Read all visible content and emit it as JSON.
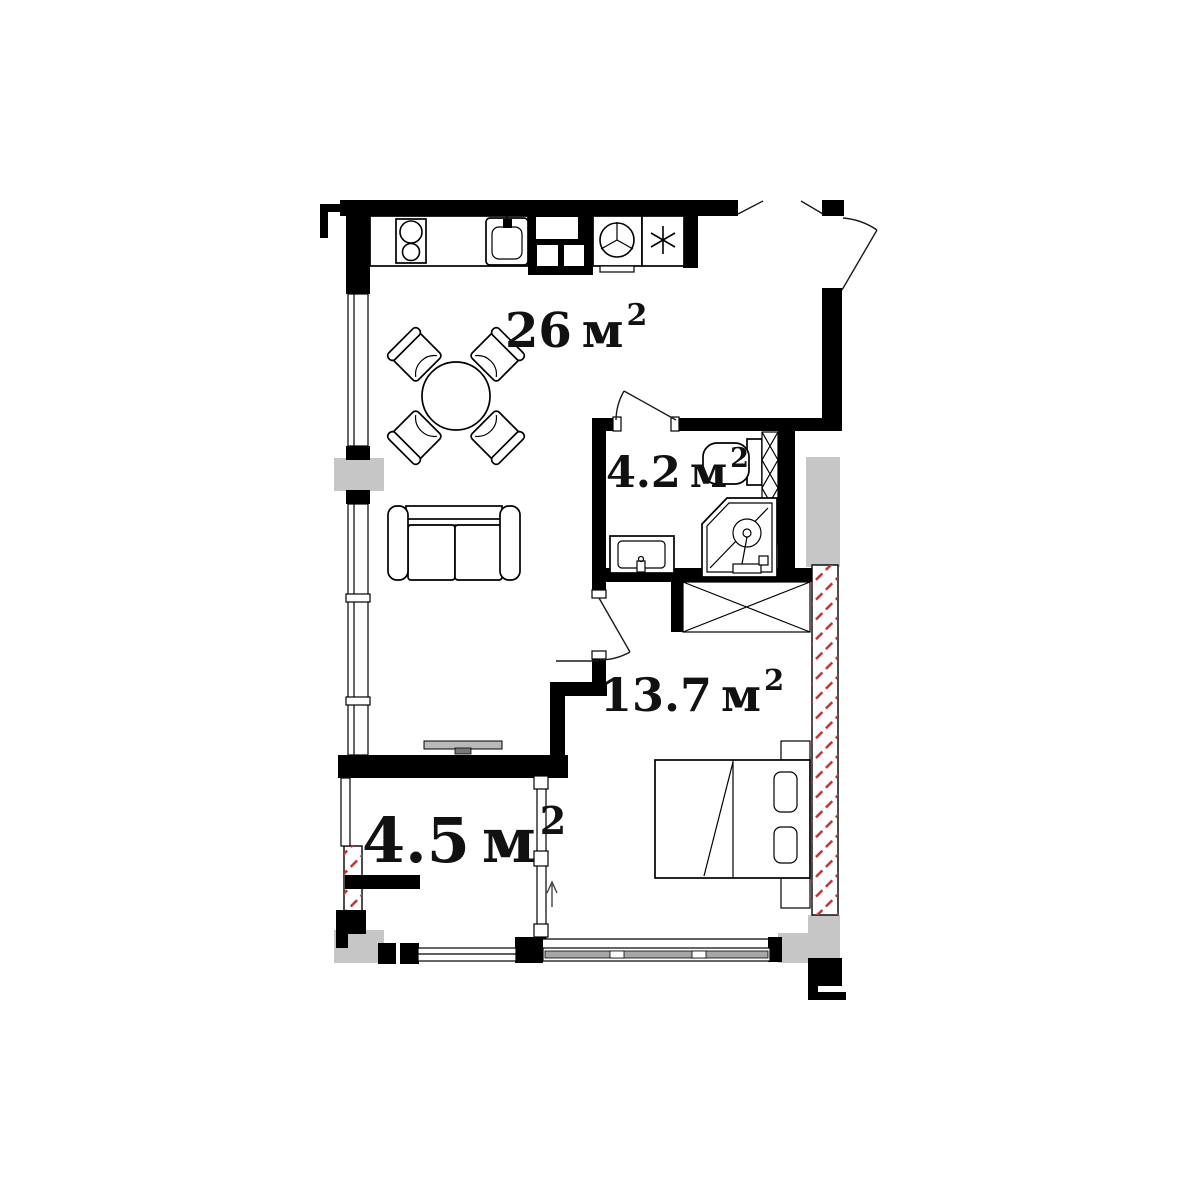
{
  "plan_title": "one-room apartment floor plan",
  "palette": {
    "wall": "#000000",
    "column_fill": "#c6c6c6",
    "hatch_red": "#c03232",
    "glass_gray": "#a6a6a6",
    "background": "#ffffff",
    "label_color": "#111111"
  },
  "rooms": [
    {
      "name": "kitchen-living-room",
      "area": "26",
      "unit": "м",
      "sup": "2"
    },
    {
      "name": "bathroom",
      "area": "4.2",
      "unit": "м",
      "sup": "2"
    },
    {
      "name": "bedroom",
      "area": "13.7",
      "unit": "м",
      "sup": "2"
    },
    {
      "name": "balcony",
      "area": "4.5",
      "unit": "м",
      "sup": "2"
    }
  ],
  "fixtures": [
    "stove",
    "kitchen-sink",
    "ventilation-shaft",
    "washing-machine",
    "refrigerator",
    "dining-table",
    "chair",
    "sofa",
    "tv",
    "toilet",
    "shower-cabin",
    "washbasin",
    "wardrobe",
    "bed",
    "pillow",
    "nightstand",
    "entrance-door",
    "bathroom-door",
    "bedroom-door",
    "window",
    "balcony-partition",
    "direction-arrow"
  ]
}
